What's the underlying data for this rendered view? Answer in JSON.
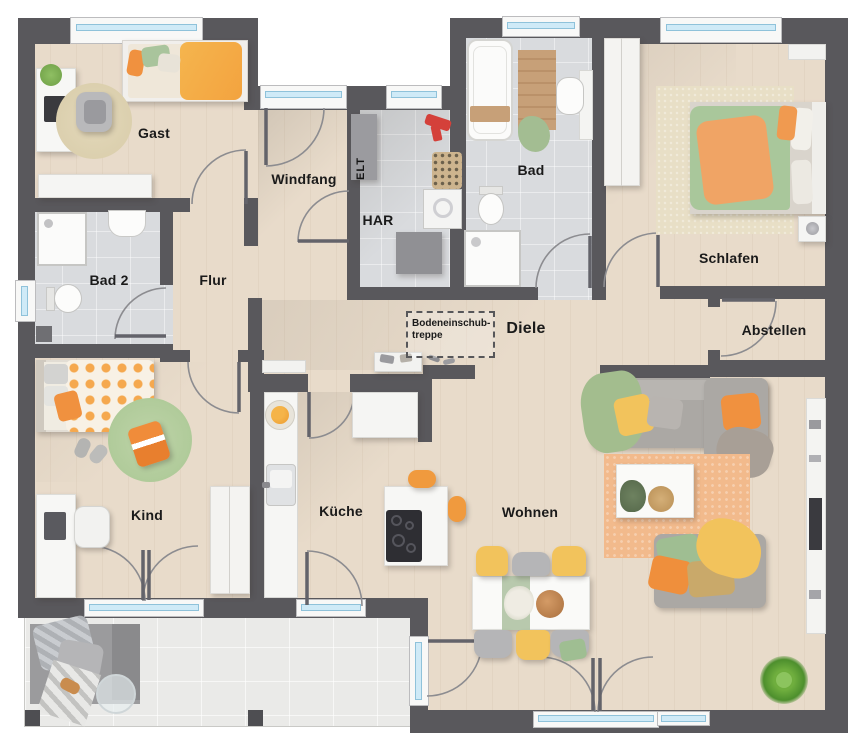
{
  "plan": {
    "title": "Erdgeschoss Grundriss",
    "rooms": {
      "gast": "Gast",
      "windfang": "Windfang",
      "elt": "ELT",
      "har": "HAR",
      "bad": "Bad",
      "schlafen": "Schlafen",
      "bad2": "Bad 2",
      "flur": "Flur",
      "diele": "Diele",
      "abstellen": "Abstellen",
      "kind": "Kind",
      "kueche": "Küche",
      "wohnen": "Wohnen"
    },
    "attic_hatch": {
      "line1": "Bodeneinschub-",
      "line2": "treppe"
    },
    "colors": {
      "wall": "#59585c",
      "wood_floor": "#e8dbca",
      "bath_tile": "#d9dbde",
      "terrace_tile": "#eaeae8",
      "window_glass": "#cfeaf7",
      "accent_orange": "#f09a3e",
      "accent_yellow": "#f2c35c",
      "accent_green": "#a3bd92",
      "sofa_gray": "#aba8a4"
    }
  }
}
